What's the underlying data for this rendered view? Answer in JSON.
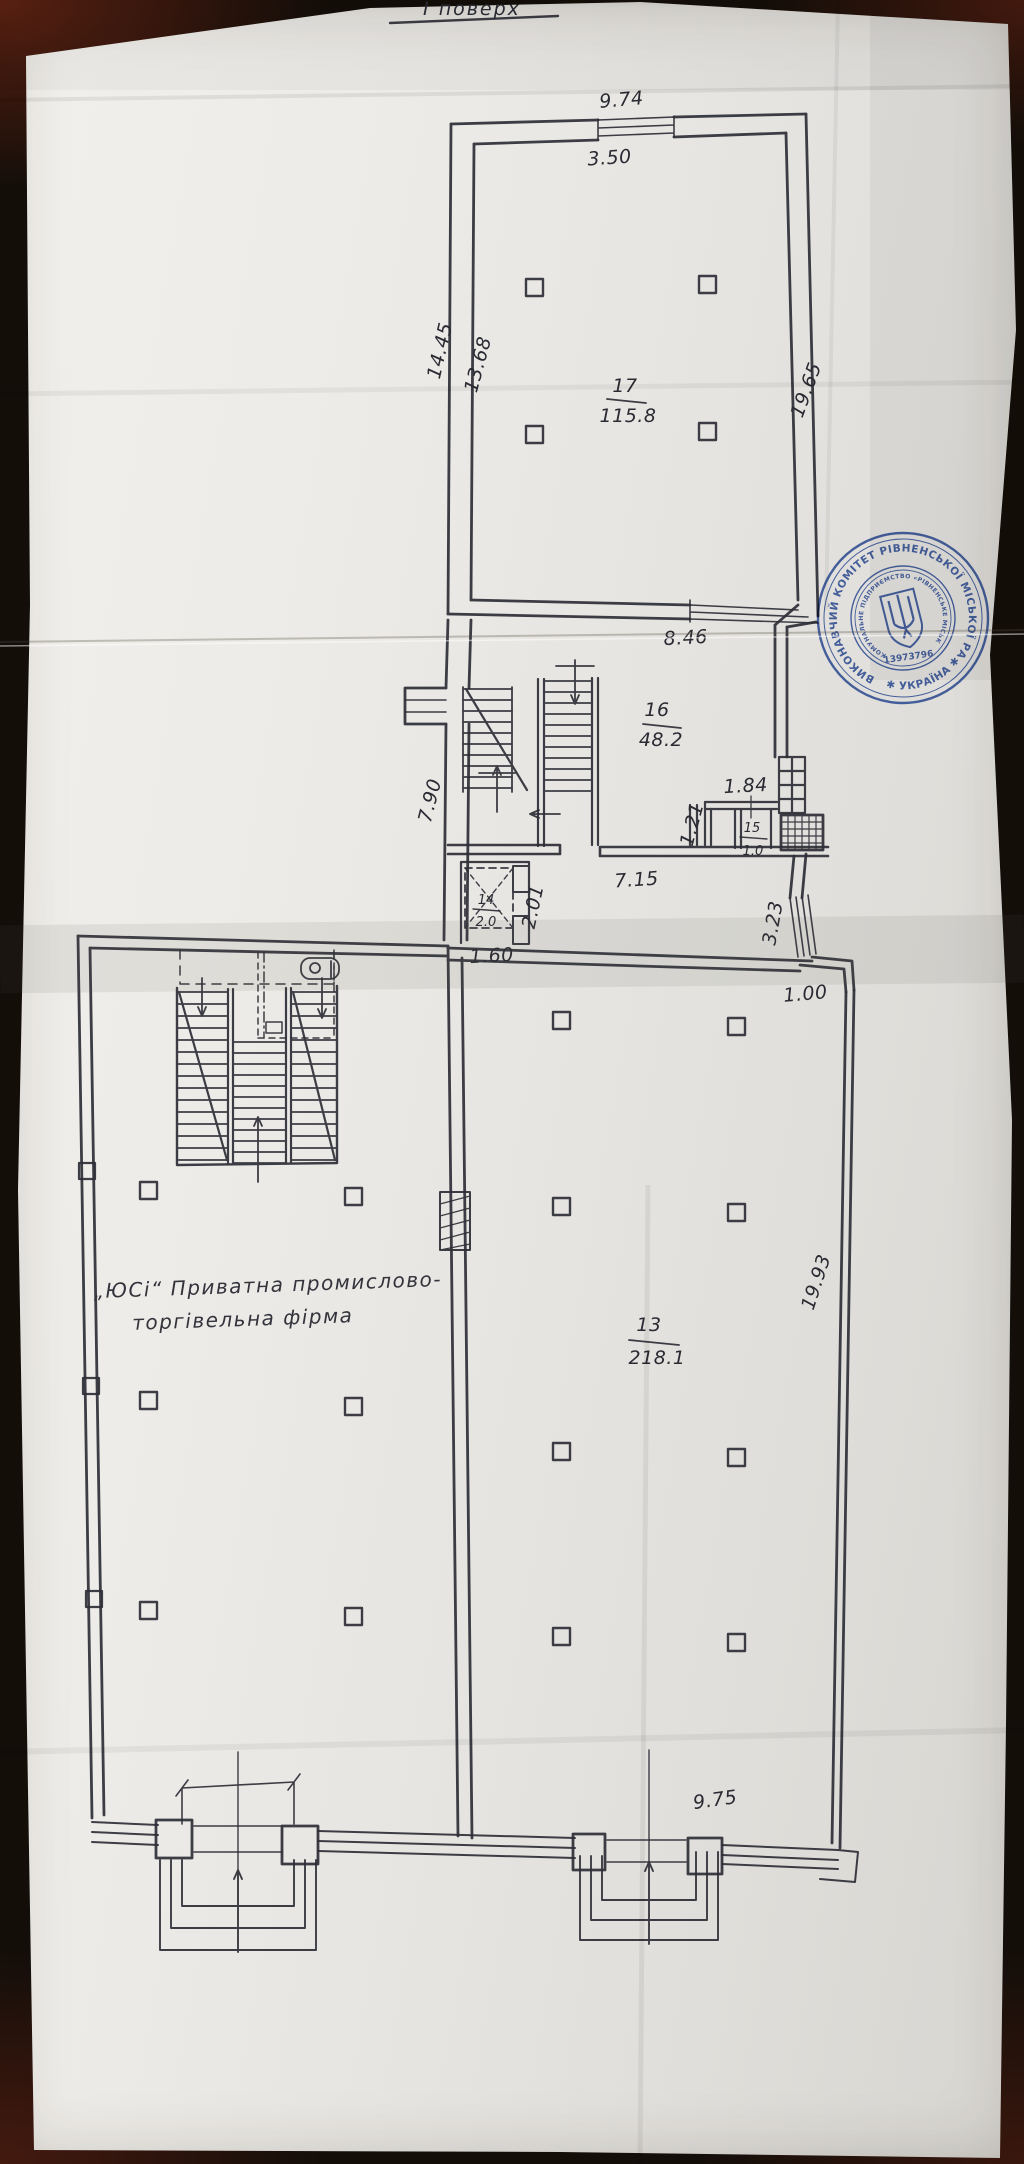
{
  "title": {
    "text": "І поверх"
  },
  "plan": {
    "dims": {
      "top_width": "9.74",
      "top_window": "3.50",
      "left_outer": "14.45",
      "left_inner": "13.68",
      "right_upper": "19.65",
      "mid_width": "8.46",
      "mid_left": "7.90",
      "niche_width": "1.84",
      "niche_depth": "1.21",
      "shaft_width": "2.01",
      "shaft_bottom": "1.60",
      "corridor_width": "7.15",
      "right_window": "3.23",
      "right_step": "1.00",
      "hall_right": "19.93",
      "hall_bottom": "9.75"
    },
    "rooms": {
      "r17": {
        "num": "17",
        "area": "115.8"
      },
      "r16": {
        "num": "16",
        "area": "48.2"
      },
      "r15": {
        "num": "15",
        "area": "1.0"
      },
      "r14": {
        "num": "14",
        "area": "2.0"
      },
      "r13": {
        "num": "13",
        "area": "218.1"
      }
    },
    "annotation": {
      "line1": "„ЮСі“ Приватна промислово-",
      "line2": "торгівельна фірма"
    }
  },
  "stamp": {
    "outer": "ВИКОНАВЧИЙ КОМІТЕТ РІВНЕНСЬКОЇ МІСЬКОЇ РАДИ",
    "inner": "КОМУНАЛЬНЕ ПІДПРИЄМСТВО «РІВНЕНСЬКЕ МІСЬКЕ БЮРО ТЕХНІЧНОЇ ІНВЕНТАРИЗАЦІЇ»",
    "country": "✱ УКРАЇНА ✱",
    "number": "13973796",
    "color": "#2c51a6"
  },
  "colors": {
    "ink": "#2e2e37",
    "paper": "#edebe7",
    "background": "#140e09",
    "stamp": "#2c51a6"
  }
}
